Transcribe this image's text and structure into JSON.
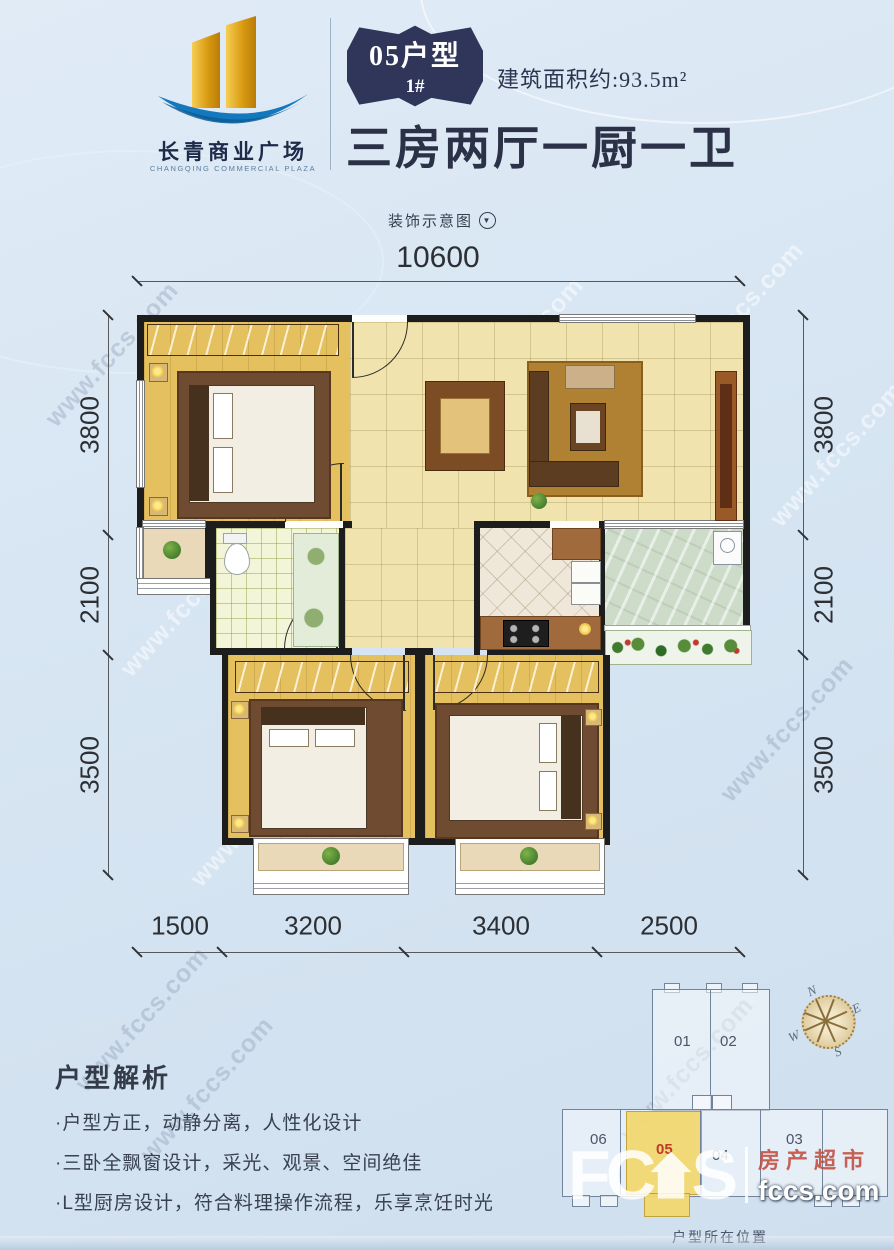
{
  "header": {
    "logo": {
      "name_cn": "长青商业广场",
      "name_en": "CHANGQING COMMERCIAL PLAZA"
    },
    "badge": {
      "unit_type": "05户型",
      "building": "1#"
    },
    "area_label": "建筑面积约:93.5m²",
    "title": "三房两厅一厨一卫"
  },
  "plan": {
    "schematic_label": "装饰示意图",
    "dimensions": {
      "top": "10600",
      "left": [
        "3800",
        "2100",
        "3500"
      ],
      "right": [
        "3800",
        "2100",
        "3500"
      ],
      "bottom": [
        "1500",
        "3200",
        "3400",
        "2500"
      ]
    }
  },
  "analysis": {
    "heading": "户型解析",
    "bullets": [
      "·户型方正，动静分离，人性化设计",
      "·三卧全飘窗设计，采光、观景、空间绝佳",
      "·L型厨房设计，符合料理操作流程，乐享烹饪时光"
    ]
  },
  "locator": {
    "caption": "户型所在位置",
    "units": [
      "01",
      "02",
      "06",
      "05",
      "04",
      "03"
    ],
    "highlighted_unit": "05",
    "compass": {
      "n": "N",
      "e": "E",
      "s": "S",
      "w": "W"
    }
  },
  "watermark": {
    "text": "www.fccs.com"
  },
  "brand": {
    "letters_left": "FC",
    "letters_right": "S",
    "cn": "房产超市",
    "site": "fccs.com"
  },
  "colors": {
    "badge_navy": "#2f3659",
    "logo_gold": "#d99b12",
    "logo_blue": "#1478be",
    "highlight_yellow": "#f2d76b",
    "highlight_red": "#c0392b",
    "background_blue": "#d8e6f3"
  }
}
